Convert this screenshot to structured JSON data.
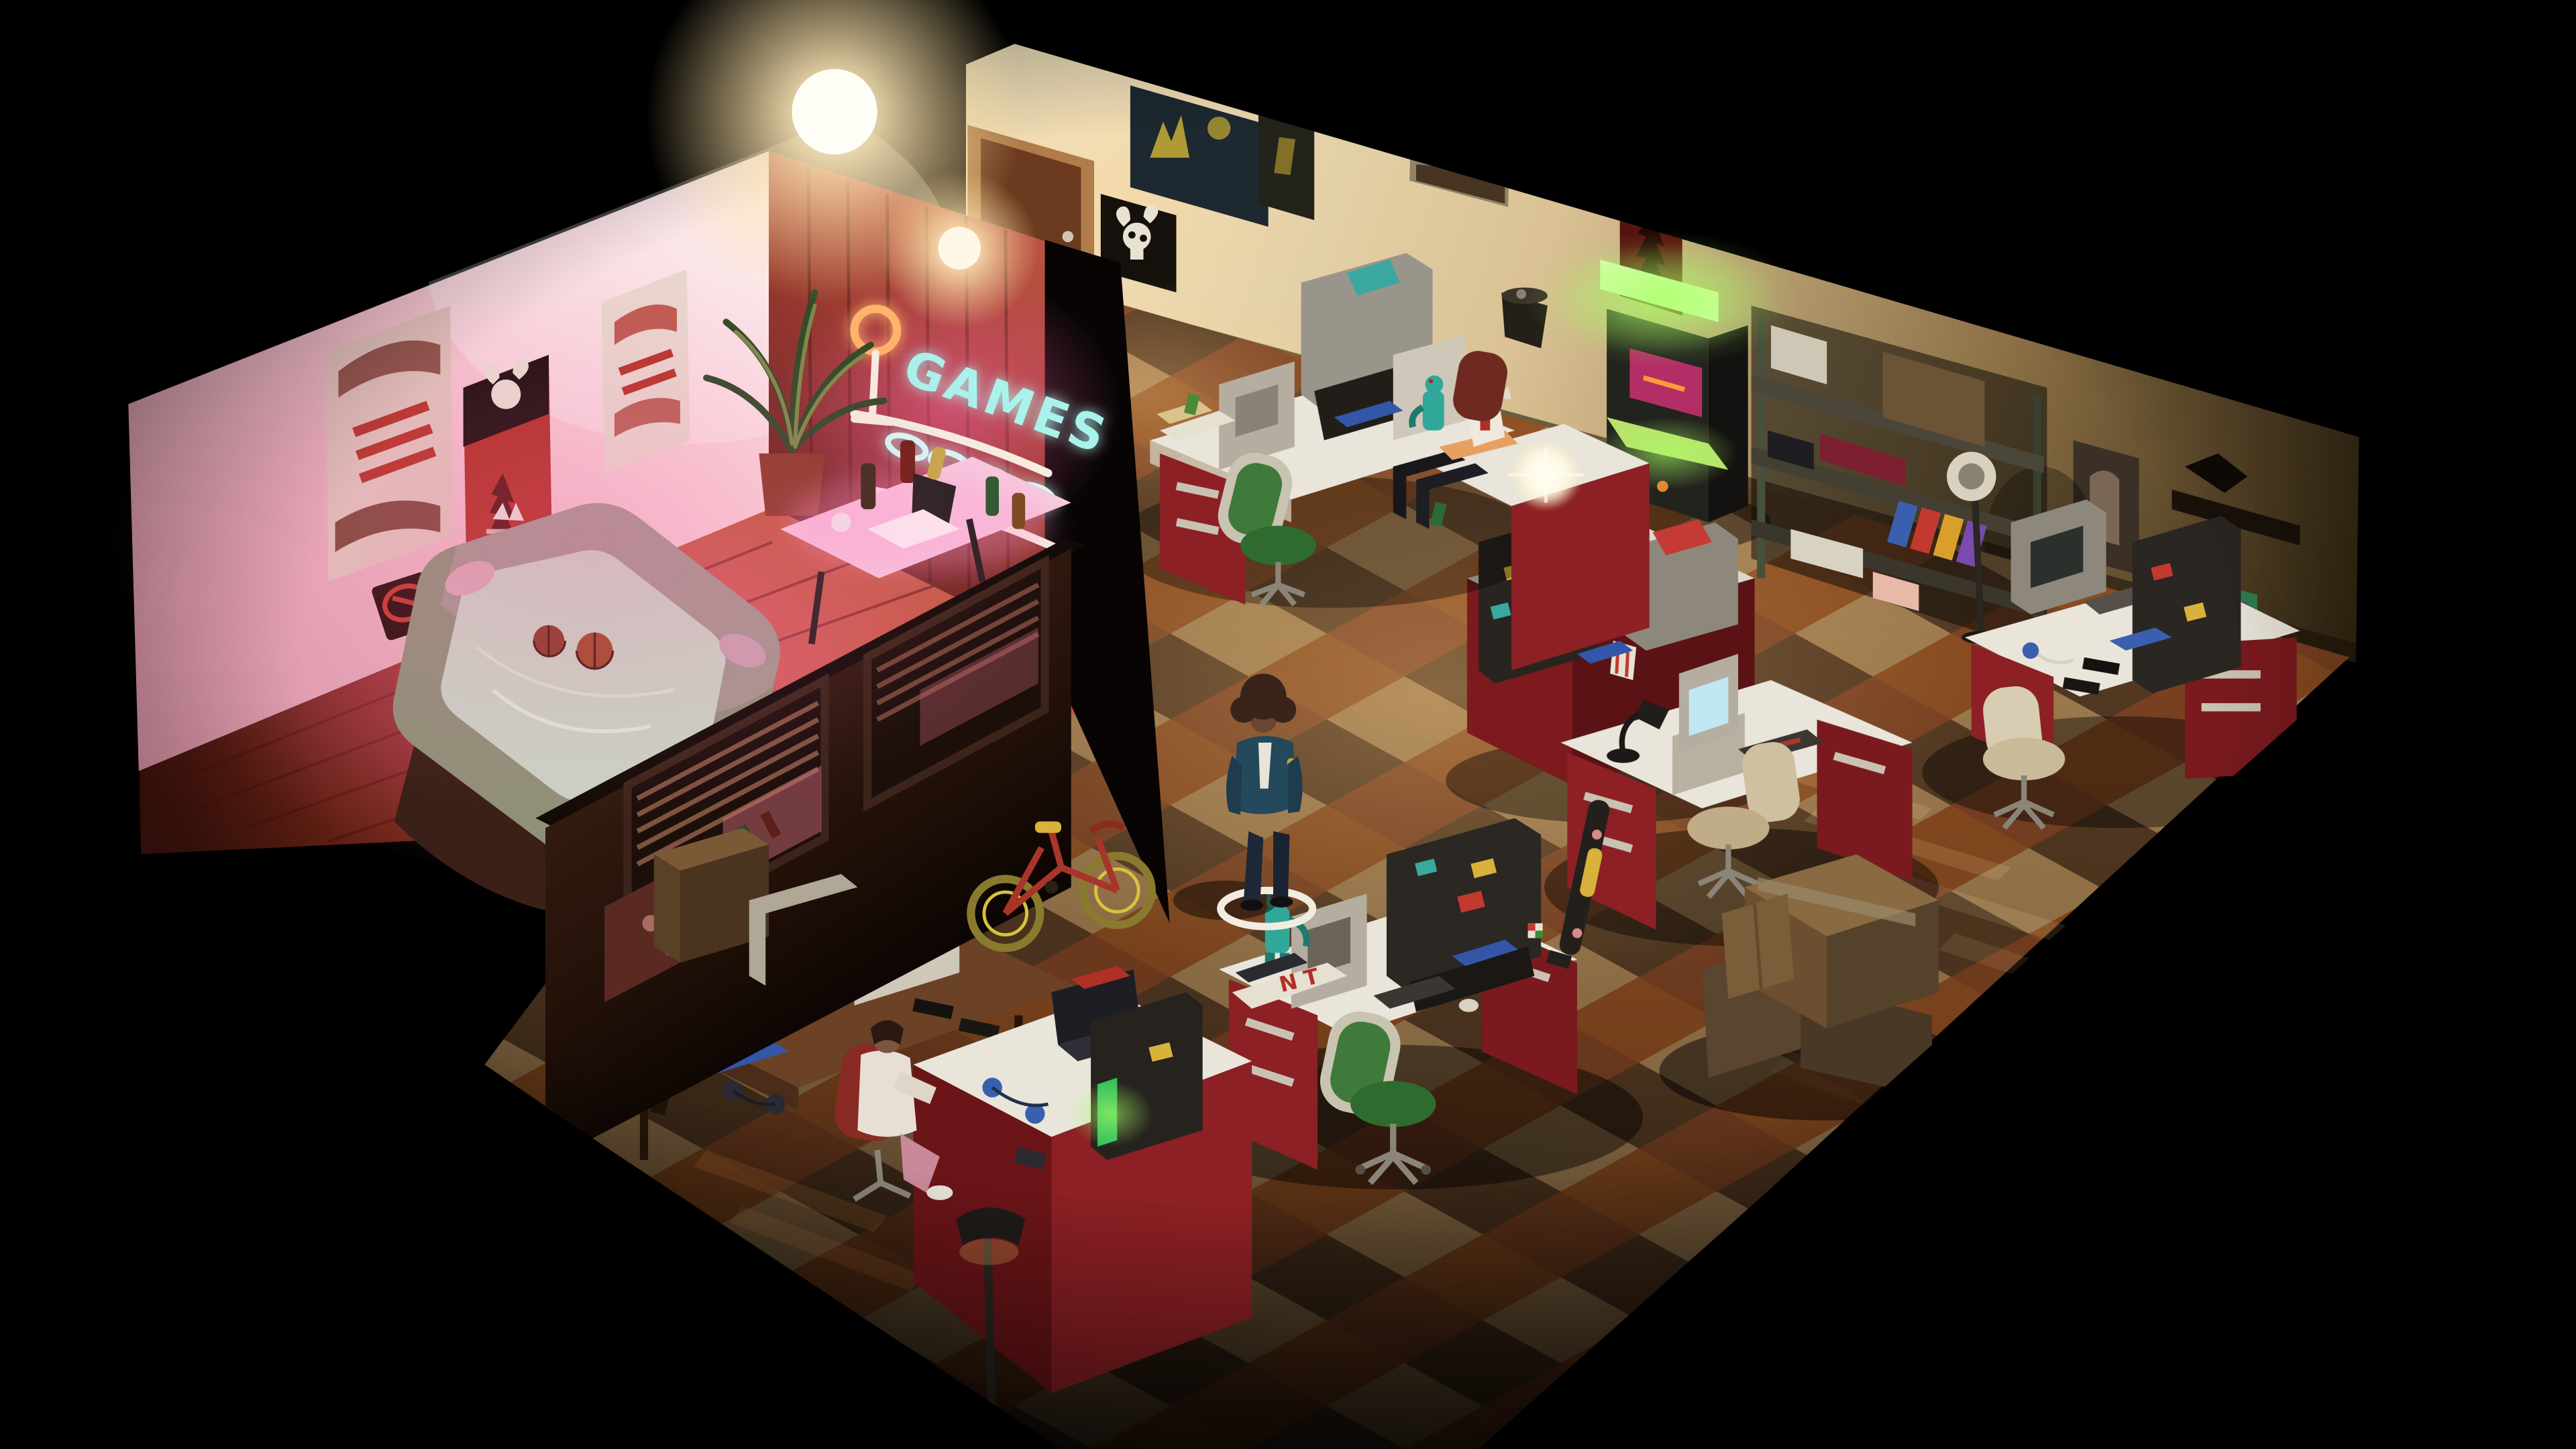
{
  "scene": {
    "neon_sign": {
      "text": "GAMES",
      "color": "#aaf2ec",
      "ring_color": "#ffb36b",
      "stroke_color": "#f7efe0"
    },
    "tv": {
      "screen_text": "GAME OVER",
      "text_color": "#55e055"
    },
    "desk_paper": {
      "letters": "N T"
    },
    "character": {
      "state": "selected",
      "ring_color": "#f2ece0"
    },
    "palette": {
      "background": "#000000",
      "wall_cream_lit": "#f0e1bd",
      "wall_cream_dark": "#2c2213",
      "wall_pink_lit": "#f6cdd4",
      "wall_wood_red": "#9c3b30",
      "divider_wood": "#2c1810",
      "floor_wood_lit": "#b34a35",
      "carpet_tan": "#b28a58",
      "carpet_orange": "#9a5524",
      "carpet_brown": "#5e4026",
      "carpet_rust": "#8a4a26",
      "desk_top": "#e9e5da",
      "desk_red": "#8c2024",
      "chair_green": "#3f7a3a",
      "chair_red": "#8a2a24",
      "chair_beige": "#cfc0a0",
      "arcade_glow": "#b8e878",
      "neon_cyan": "#aaf2ec",
      "neon_ring": "#ffb36b"
    }
  }
}
